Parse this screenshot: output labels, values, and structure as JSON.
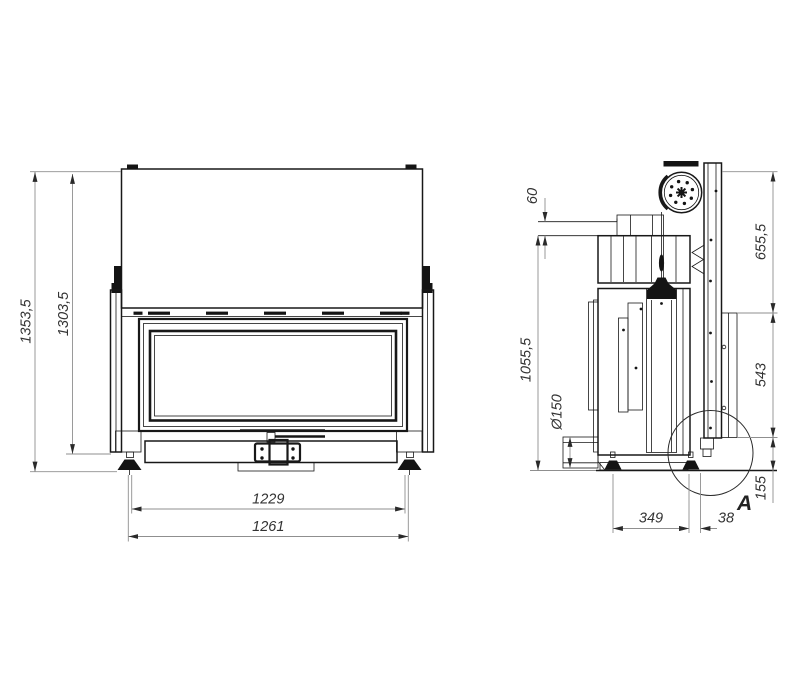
{
  "colors": {
    "background": "#ffffff",
    "object_line": "#181818",
    "dimension_line": "#8f8f8f",
    "dimension_text": "#333333"
  },
  "front_view": {
    "name": "front-view",
    "dims": {
      "total_height": "1353,5",
      "frame_height": "1303,5",
      "glass_width": "1229",
      "overall_width": "1261"
    }
  },
  "side_view": {
    "name": "side-view",
    "dims": {
      "top_offset": "60",
      "upper_section": "655,5",
      "left_height": "1055,5",
      "flue_diameter": "Ø150",
      "mid_section": "543",
      "bottom_section": "155",
      "foot_spacing": "349",
      "rail_offset": "38"
    },
    "detail_label": "A"
  }
}
